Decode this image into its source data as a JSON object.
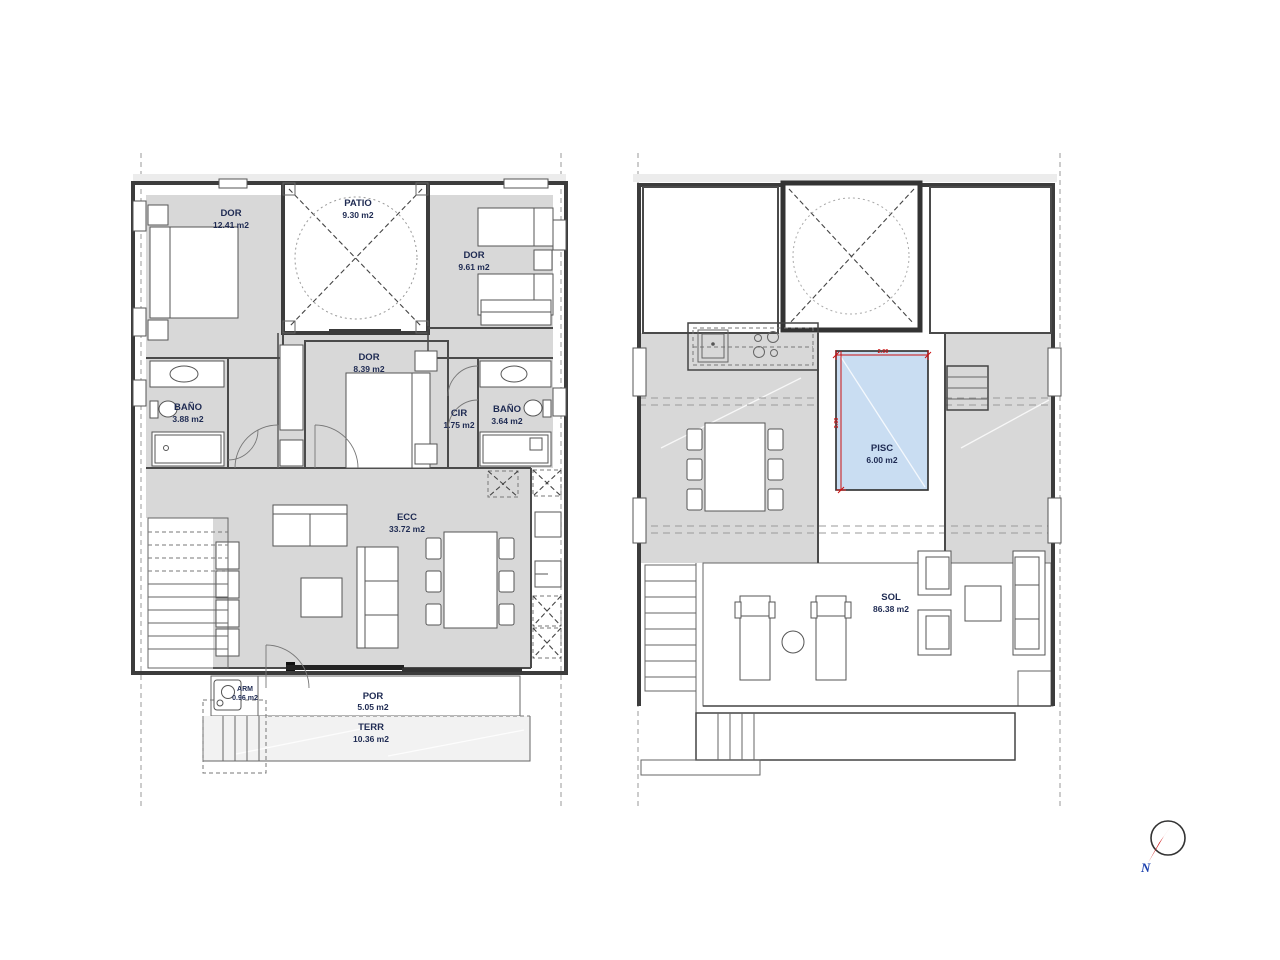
{
  "document": {
    "background": "#ffffff",
    "type": "floor-plan-drawing"
  },
  "colors": {
    "room_fill": "#d8d8d8",
    "porch_fill": "#f2f2f2",
    "solarium_fill": "#e4eee0",
    "pool_fill": "#c9ddf2",
    "wall": "#4a4a4a",
    "label_text": "#1e2a52",
    "dimension_red": "#cc1111",
    "boundary_dash": "#aaaaaa",
    "compass_north_blue": "#1a3fae"
  },
  "floor1": {
    "name": "ground-floor-plan",
    "rooms": [
      {
        "label": "DOR",
        "area": "12.41 m2"
      },
      {
        "label": "PATIO",
        "area": "9.30 m2"
      },
      {
        "label": "DOR",
        "area": "9.61 m2"
      },
      {
        "label": "DOR",
        "area": "8.39 m2"
      },
      {
        "label": "BAÑO",
        "area": "3.88 m2"
      },
      {
        "label": "CIR",
        "area": "1.75 m2"
      },
      {
        "label": "BAÑO",
        "area": "3.64 m2"
      },
      {
        "label": "ECC",
        "area": "33.72 m2"
      },
      {
        "label": "ARM",
        "area": "0.96 m2"
      },
      {
        "label": "POR",
        "area": "5.05 m2"
      },
      {
        "label": "TERR",
        "area": "10.36 m2"
      }
    ]
  },
  "floor2": {
    "name": "roof-solarium-plan",
    "rooms": [
      {
        "label": "PISC",
        "area": "6.00 m2"
      },
      {
        "label": "SOL",
        "area": "86.38 m2"
      }
    ],
    "pool": {
      "width_label": "2.00",
      "height_label": "3.00"
    }
  },
  "compass": {
    "north_label": "N"
  }
}
